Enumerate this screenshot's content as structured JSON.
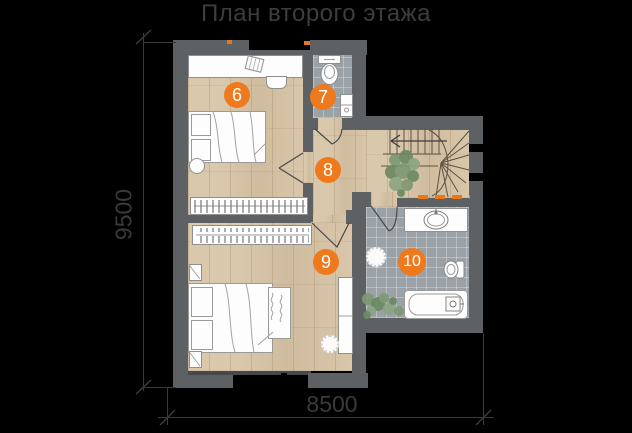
{
  "title": "План второго этажа",
  "dimensions": {
    "height_mm": "9500",
    "width_mm": "8500"
  },
  "rooms": [
    {
      "number": "6"
    },
    {
      "number": "7"
    },
    {
      "number": "8"
    },
    {
      "number": "9"
    },
    {
      "number": "10"
    }
  ],
  "colors": {
    "background": "#000000",
    "wall": "#5e6163",
    "wood_floor": "#d6c2a4",
    "tile_floor": "#9aa1a7",
    "accent_orange": "#ee7a1d",
    "dimension_line": "#3a3a3a",
    "title_text": "#3d3d3d"
  }
}
